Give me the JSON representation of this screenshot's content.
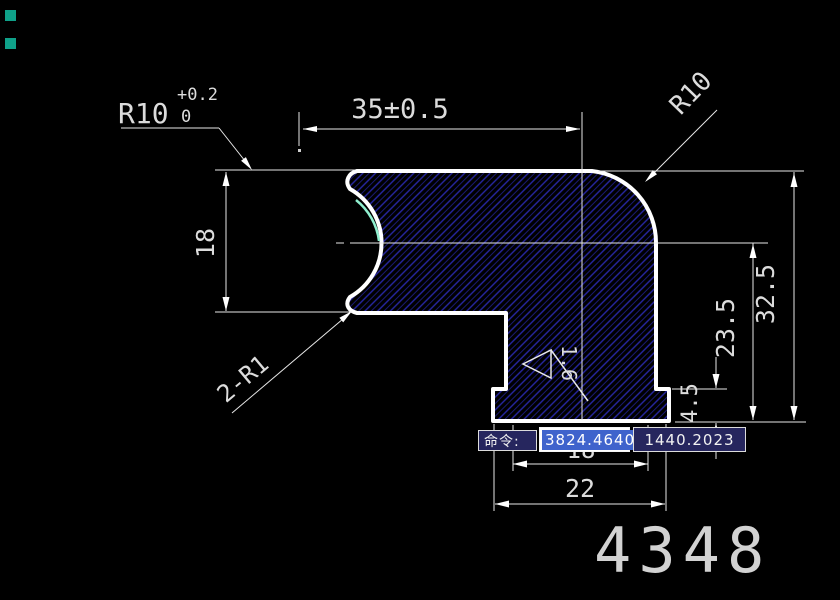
{
  "colors": {
    "background": "#000000",
    "outline": "#ffffff",
    "hatch_blue": "#2828a6",
    "hatch_blue_dim": "#1a1a72",
    "highlight_cyan": "#90efcf",
    "dim_text": "#dcdcdc",
    "tolerance_dim_yellow": "#d8d878",
    "selection_blue": "#3f63cc",
    "command_box_bg": "#26265e",
    "grip_teal": "#0fa189"
  },
  "drawing": {
    "part_number": "4348",
    "dims": {
      "top_width": "35±0.5",
      "scallop_radius": "R10",
      "scallop_tol_plus": "+0.2",
      "scallop_tol_minus": "0",
      "corner_radius": "R10",
      "left_height": "18",
      "fillet_note": "2-R1",
      "right_total_height": "32.5",
      "right_mid_height": "23.5",
      "foot_height": "4.5",
      "foot_inner_width": "18",
      "foot_outer_width": "22",
      "roughness_value": "1.6"
    }
  },
  "command_bar": {
    "prompt": "命令:",
    "value_x": "3824.4640",
    "value_y": "1440.2023"
  }
}
